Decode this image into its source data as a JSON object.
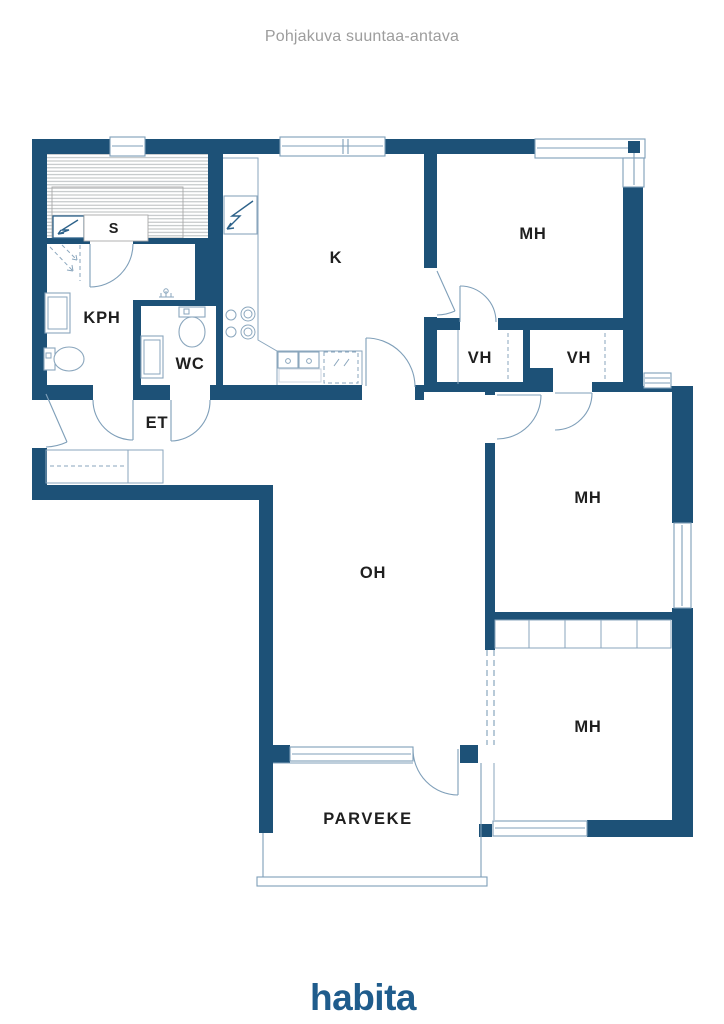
{
  "title": "Pohjakuva suuntaa-antava",
  "brand": {
    "logo_text": "habita",
    "logo_color": "#1f5c8c"
  },
  "floorplan": {
    "wall_color": "#1d5177",
    "line_color": "#7f9fb9",
    "label_color": "#1f1f1f",
    "title_color": "#9d9d9d",
    "sauna_stripe_color": "#b8bcbe",
    "rooms": [
      {
        "id": "sauna",
        "label": "S"
      },
      {
        "id": "bathroom",
        "label": "KPH"
      },
      {
        "id": "toilet",
        "label": "WC"
      },
      {
        "id": "entry-hall",
        "label": "ET"
      },
      {
        "id": "kitchen",
        "label": "K"
      },
      {
        "id": "bedroom-1",
        "label": "MH"
      },
      {
        "id": "closet-1",
        "label": "VH"
      },
      {
        "id": "closet-2",
        "label": "VH"
      },
      {
        "id": "bedroom-2",
        "label": "MH"
      },
      {
        "id": "living-room",
        "label": "OH"
      },
      {
        "id": "bedroom-3",
        "label": "MH"
      },
      {
        "id": "balcony",
        "label": "PARVEKE"
      }
    ]
  }
}
